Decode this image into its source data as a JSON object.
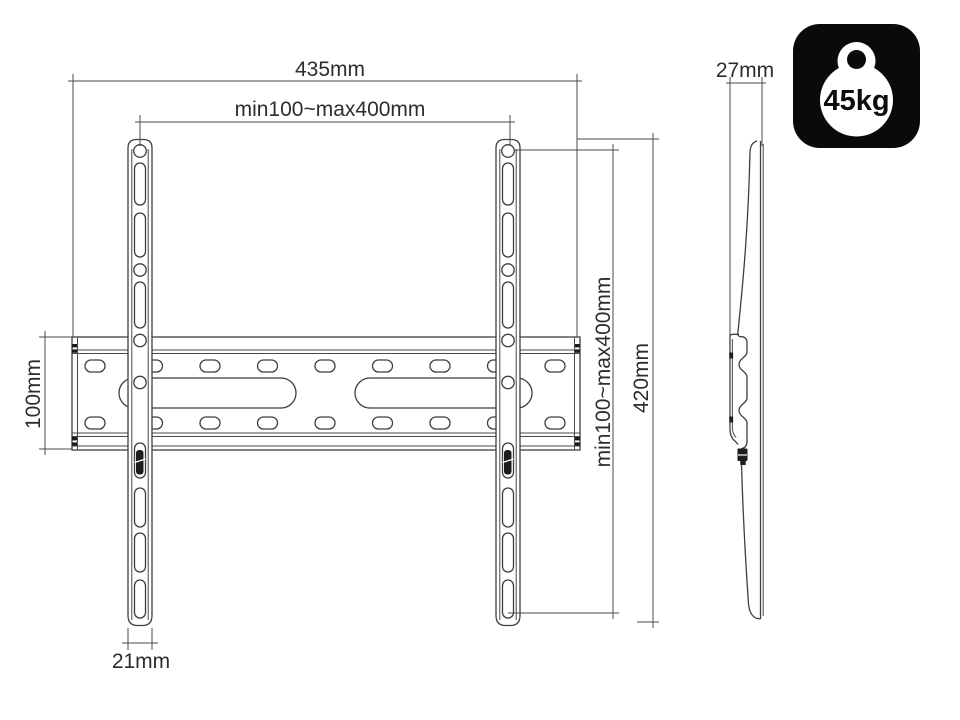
{
  "drawing": {
    "subject": "tv-wall-mount-technical-drawing",
    "views": {
      "front_view": {
        "dimensions": {
          "total_width": "435mm",
          "hole_pattern_width": "min100~max400mm",
          "plate_height": "100mm",
          "rail_width": "21mm",
          "hole_pattern_height": "min100~max400mm",
          "bracket_height": "420mm"
        }
      },
      "side_view": {
        "dimensions": {
          "depth": "27mm"
        }
      }
    },
    "badge": {
      "max_load": "45kg",
      "icon": "weight-kettlebell-icon",
      "bg_color": "#0a0a0a",
      "fg_color": "#ffffff"
    },
    "colors": {
      "line": "#3f3f3f",
      "text": "#2d2d2d",
      "background": "#ffffff"
    }
  }
}
